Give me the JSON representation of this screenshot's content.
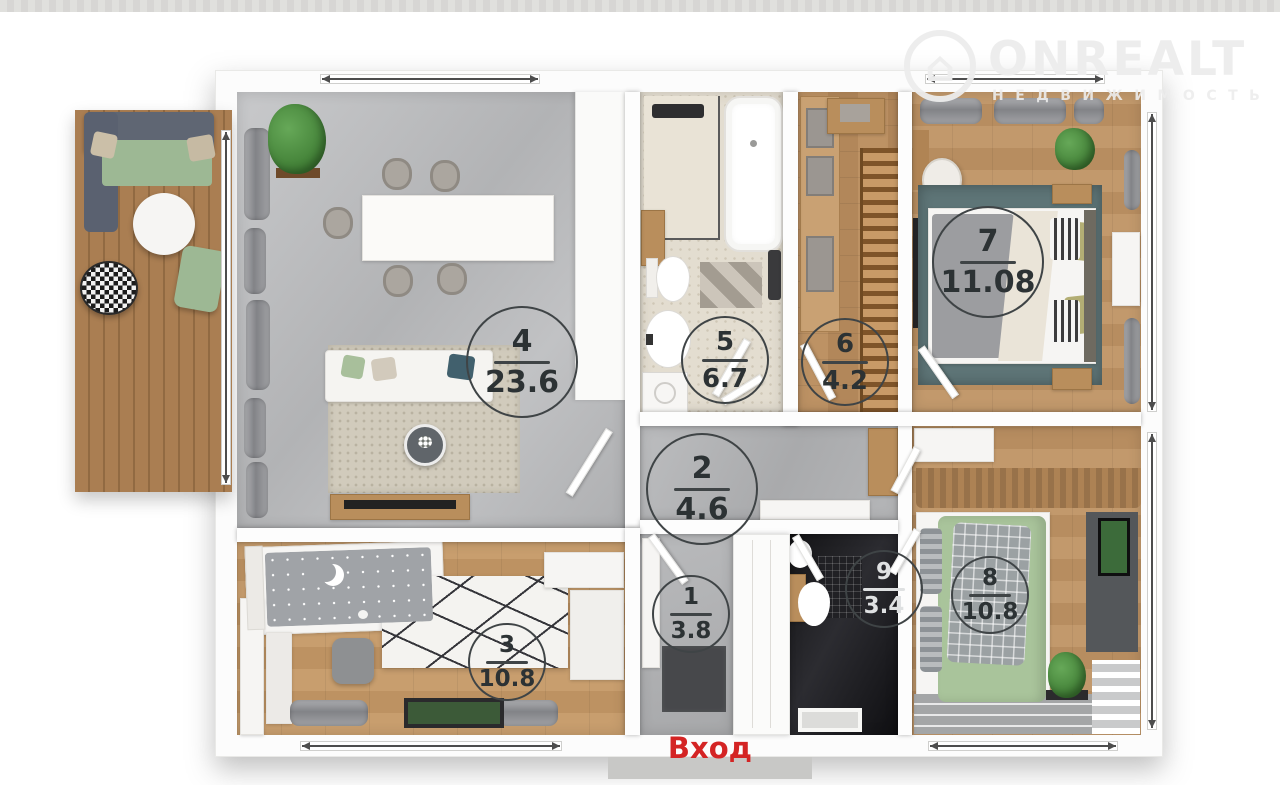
{
  "watermark": {
    "brand": "ONREALT",
    "subtitle": "НЕДВИЖИМОСТЬ",
    "house_icon": "⌂"
  },
  "plan": {
    "entrance_label": "Вход",
    "rooms": [
      {
        "number": "1",
        "area": "3.8"
      },
      {
        "number": "2",
        "area": "4.6"
      },
      {
        "number": "3",
        "area": "10.8"
      },
      {
        "number": "4",
        "area": "23.6"
      },
      {
        "number": "5",
        "area": "6.7"
      },
      {
        "number": "6",
        "area": "4.2"
      },
      {
        "number": "7",
        "area": "11.08"
      },
      {
        "number": "8",
        "area": "10.8"
      },
      {
        "number": "9",
        "area": "3.4"
      }
    ]
  },
  "colors": {
    "entrance_red": "#d42424",
    "label_ink": "#2c3234",
    "wall_white": "#fcfcfc",
    "wood_floor": "#bd9264",
    "marble_grey": "#b5b6b8",
    "dark_bathroom": "#1a1a1e",
    "teal_rug": "#5e7577",
    "green_textile": "#a9c49b",
    "deck_wood": "#aa7e52",
    "watermark_white": "#ececec"
  }
}
